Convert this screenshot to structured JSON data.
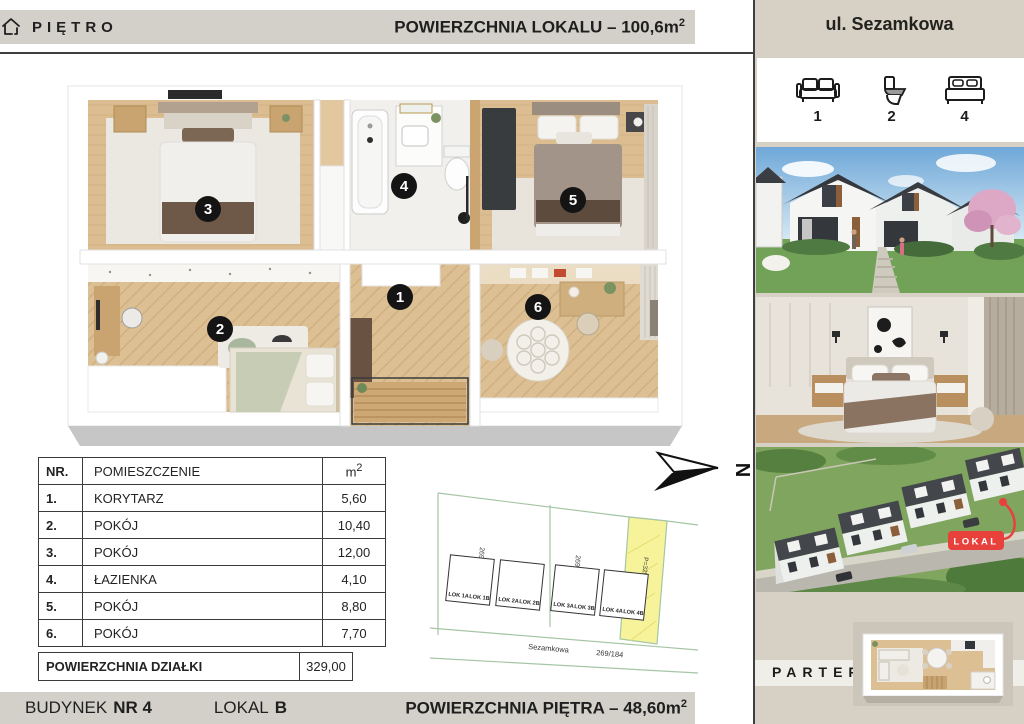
{
  "header": {
    "level_label": "PIĘTRO",
    "area_text": "POWIERZCHNIA LOKALU – 100,6m",
    "area_sup": "2"
  },
  "sidebar": {
    "street": "ul. Sezamkowa",
    "stats": [
      {
        "icon": "sofa-icon",
        "count": "1"
      },
      {
        "icon": "toilet-icon",
        "count": "2"
      },
      {
        "icon": "bed-icon",
        "count": "4"
      }
    ],
    "lokal_badge": "LOKAL",
    "parter_label": "PARTER"
  },
  "floor_plan": {
    "markers": [
      "1",
      "2",
      "3",
      "4",
      "5",
      "6"
    ]
  },
  "room_table": {
    "headers": {
      "nr": "NR.",
      "room": "POMIESZCZENIE",
      "unit": "m",
      "unit_sup": "2"
    },
    "rows": [
      {
        "nr": "1.",
        "name": "KORYTARZ",
        "area": "5,60"
      },
      {
        "nr": "2.",
        "name": "POKÓJ",
        "area": "10,40"
      },
      {
        "nr": "3.",
        "name": "POKÓJ",
        "area": "12,00"
      },
      {
        "nr": "4.",
        "name": "ŁAZIENKA",
        "area": "4,10"
      },
      {
        "nr": "5.",
        "name": "POKÓJ",
        "area": "8,80"
      },
      {
        "nr": "6.",
        "name": "POKÓJ",
        "area": "7,70"
      }
    ],
    "footer": {
      "label": "POWIERZCHNIA DZIAŁKI",
      "area": "329,00"
    }
  },
  "site_plan": {
    "north_label": "N",
    "parcel_left": "269/186",
    "parcel_mid": "269/185",
    "highlight_label": "P=329 m2",
    "street_name": "Sezamkowa",
    "street_parcel": "269/184",
    "buildings": [
      [
        "LOK 1A",
        "LOK 1B"
      ],
      [
        "LOK 2A",
        "LOK 2B"
      ],
      [
        "LOK 3A",
        "LOK 3B"
      ],
      [
        "LOK 4A",
        "LOK 4B"
      ]
    ]
  },
  "footer": {
    "building_label": "BUDYNEK",
    "building_value": "NR 4",
    "unit_label": "LOKAL",
    "unit_value": "B",
    "area_text": "POWIERZCHNIA PIĘTRA – 48,60m",
    "area_sup": "2"
  },
  "colors": {
    "accent_red": "#e8413c",
    "bar_gray": "#d3d0c9",
    "sidebar_beige": "#d7d1c5",
    "line_dark": "#3f3f3f",
    "highlight_yellow": "#f7f39b"
  }
}
